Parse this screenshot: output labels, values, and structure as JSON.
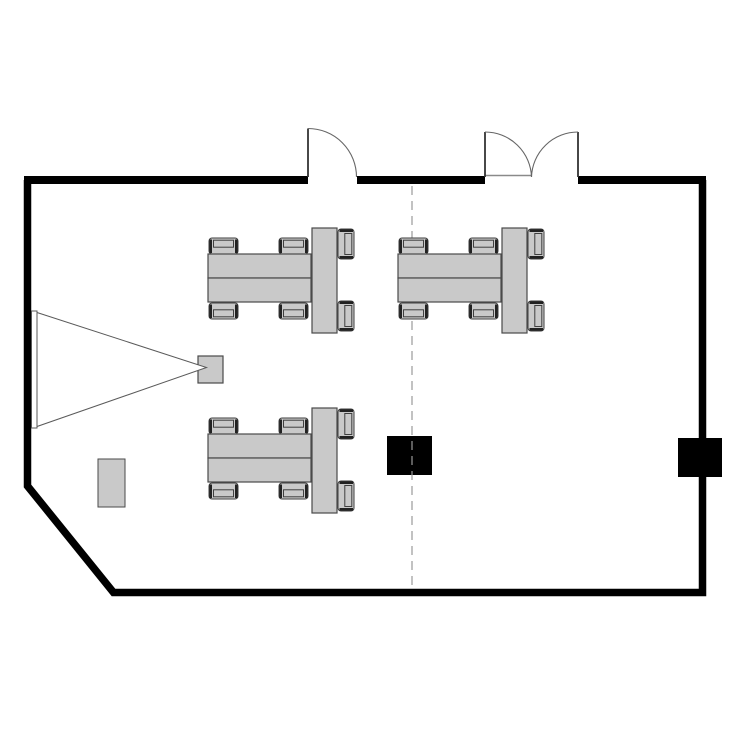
{
  "title": "classroom-floor-plan",
  "colors": {
    "background": "#ffffff",
    "wall": "#000000",
    "furniture_fill": "#c9c9c9",
    "furniture_stroke": "#4a4a4a",
    "chair_frame": "#222222",
    "chair_detail_stroke": "#3f3f3f",
    "door_stroke": "#666666",
    "door_leaf": "#333333",
    "threshold": "#8a8a8a",
    "dashed_line": "#9a9a9a",
    "floor_box": "#000000",
    "cone_stroke": "#5a5a5a",
    "screen_fill": "#ffffff"
  },
  "room": {
    "wall_thickness": 7.5,
    "outline_path": "M 27.5 180 L 27.5 486 L 113.5 592.5 L 702.5 592.5 L 702.5 180",
    "top_wall_y": 180,
    "top_wall_segments": [
      {
        "x1": 24,
        "x2": 308
      },
      {
        "x1": 357,
        "x2": 485
      },
      {
        "x1": 578,
        "x2": 706
      }
    ]
  },
  "doors": [
    {
      "id": "door-single",
      "type": "single",
      "hinge": {
        "x": 308,
        "y": 177
      },
      "leaf_top": {
        "x": 308,
        "y": 128.5
      },
      "swing_end": {
        "x": 356.5,
        "y": 177
      },
      "radius": 48.5
    },
    {
      "id": "door-double",
      "type": "double",
      "left_hinge": {
        "x": 485,
        "y": 177
      },
      "left_leaf_top": {
        "x": 485,
        "y": 132
      },
      "right_hinge": {
        "x": 578,
        "y": 177
      },
      "right_leaf_top": {
        "x": 578,
        "y": 132
      },
      "meet": {
        "x": 531.5,
        "y": 177
      },
      "radius": 46.5,
      "threshold": {
        "x1": 485,
        "x2": 531.5,
        "y": 175.5
      }
    }
  ],
  "partition_line": {
    "x": 412,
    "y1": 186,
    "y2": 589,
    "dash": "9 6"
  },
  "floor_boxes": [
    {
      "id": "floor-box-center",
      "x": 387,
      "y": 436,
      "w": 45,
      "h": 39
    },
    {
      "id": "floor-box-right-wall",
      "x": 678,
      "y": 438,
      "w": 44,
      "h": 39
    }
  ],
  "side_table": {
    "x": 98,
    "y": 459,
    "w": 27,
    "h": 48
  },
  "projection": {
    "screen": {
      "x": 31.5,
      "y": 311,
      "w": 5.5,
      "h": 117
    },
    "cone_points": "37,312.5 206.5,367.5 37,426.5",
    "projector": {
      "x": 198,
      "y": 356,
      "w": 25,
      "h": 27
    }
  },
  "table_groups": [
    {
      "id": "table-group-top-left",
      "x": 195,
      "y": 225
    },
    {
      "id": "table-group-top-right",
      "x": 385,
      "y": 225
    },
    {
      "id": "table-group-bottom-left",
      "x": 195,
      "y": 405
    }
  ],
  "table_group_template": {
    "tables": [
      {
        "x": 13,
        "y": 29,
        "w": 103,
        "h": 24
      },
      {
        "x": 13,
        "y": 53,
        "w": 103,
        "h": 24
      },
      {
        "x": 117,
        "y": 3,
        "w": 25,
        "h": 105
      }
    ],
    "chairs": [
      {
        "x": 14,
        "y": 13,
        "w": 29,
        "h": 16,
        "facing": "down"
      },
      {
        "x": 84,
        "y": 13,
        "w": 29,
        "h": 16,
        "facing": "down"
      },
      {
        "x": 14,
        "y": 78,
        "w": 29,
        "h": 16,
        "facing": "up"
      },
      {
        "x": 84,
        "y": 78,
        "w": 29,
        "h": 16,
        "facing": "up"
      },
      {
        "x": 143,
        "y": 4,
        "w": 16,
        "h": 30,
        "facing": "left"
      },
      {
        "x": 143,
        "y": 76,
        "w": 16,
        "h": 30,
        "facing": "left"
      }
    ]
  }
}
